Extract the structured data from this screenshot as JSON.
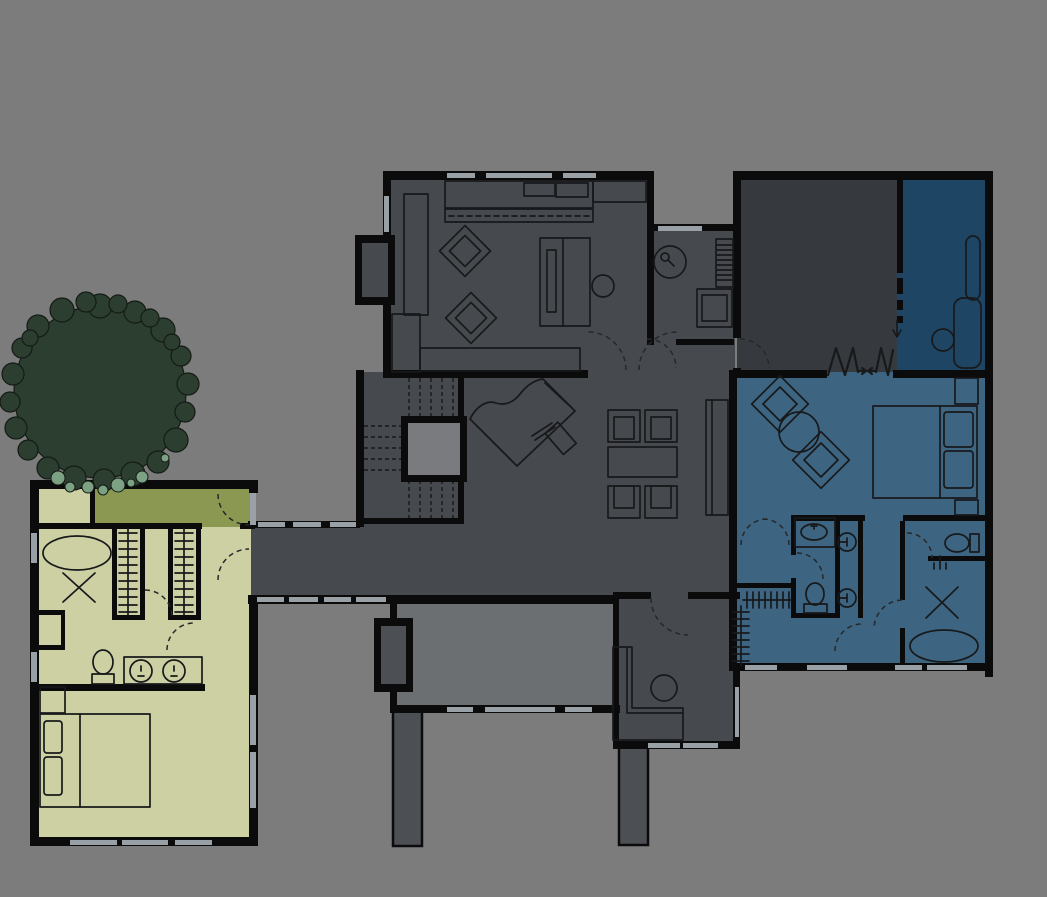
{
  "title": "residential-floor-plan",
  "colors": {
    "background": "#7c7c7c",
    "wall": "#0b0b0b",
    "window": "#99a0a6",
    "line": "#17191b",
    "door_arc": "#26282a",
    "room_main": "#46494d",
    "room_tall": "#363a3e",
    "room_flex": "#1f4564",
    "suite_master": "#3d6480",
    "wing_guest": "#cdd0a2",
    "wing_deck": "#8b9852",
    "deck_south": "#6c6f71",
    "pier": "#4c5054",
    "shaft": "#797b7e",
    "tree_dark": "#2c3e30",
    "tree_light": "#7da283",
    "tree_outline": "#141b15"
  },
  "rooms": [
    {
      "id": "living-room",
      "fill_key": "room_main",
      "features": [
        "media-cabinet",
        "two-diamond-chairs",
        "sofa",
        "round-side-table",
        "fireplace-bay",
        "bench"
      ]
    },
    {
      "id": "study",
      "fill_key": "room_main",
      "features": [
        "round-table-with-lamp",
        "book-shelf",
        "desk-chair"
      ]
    },
    {
      "id": "main-hall",
      "fill_key": "room_main",
      "features": [
        "grand-piano",
        "piano-bench",
        "dining-table",
        "four-dining-chairs",
        "stair-run",
        "shaft",
        "sideboard"
      ]
    },
    {
      "id": "corridor-link",
      "fill_key": "room_main",
      "features": [
        "window-band-north",
        "window-band-south"
      ]
    },
    {
      "id": "entry-room",
      "fill_key": "room_main",
      "features": [
        "l-shaped-bench",
        "round-table"
      ]
    },
    {
      "id": "tall-dark-room",
      "fill_key": "room_tall",
      "features": [
        "accordion-partition"
      ]
    },
    {
      "id": "flex-room",
      "fill_key": "room_flex",
      "features": [
        "chaise-lounge",
        "round-table",
        "sliding-door-arrow"
      ]
    },
    {
      "id": "master-suite",
      "fill_key": "suite_master",
      "features": [
        "bed-with-pillows",
        "two-nightstands",
        "two-diamond-chairs",
        "round-table",
        "vanity-sink",
        "toilet",
        "twin-round-sinks",
        "water-closet-toilet",
        "shower-x",
        "freestanding-tub",
        "hanger-closet"
      ]
    },
    {
      "id": "guest-wing",
      "fill_key": "wing_guest",
      "features": [
        "oval-tub",
        "shower-x",
        "two-hanger-closets",
        "toilet",
        "double-vanity",
        "bed-with-pillows",
        "nightstand"
      ]
    },
    {
      "id": "wing-deck",
      "fill_key": "wing_deck",
      "features": [
        "tree-canopy"
      ]
    },
    {
      "id": "south-deck",
      "fill_key": "deck_south",
      "features": [
        "fireplace-bay",
        "two-piers"
      ]
    }
  ],
  "door_count": 14,
  "window_count": 24
}
